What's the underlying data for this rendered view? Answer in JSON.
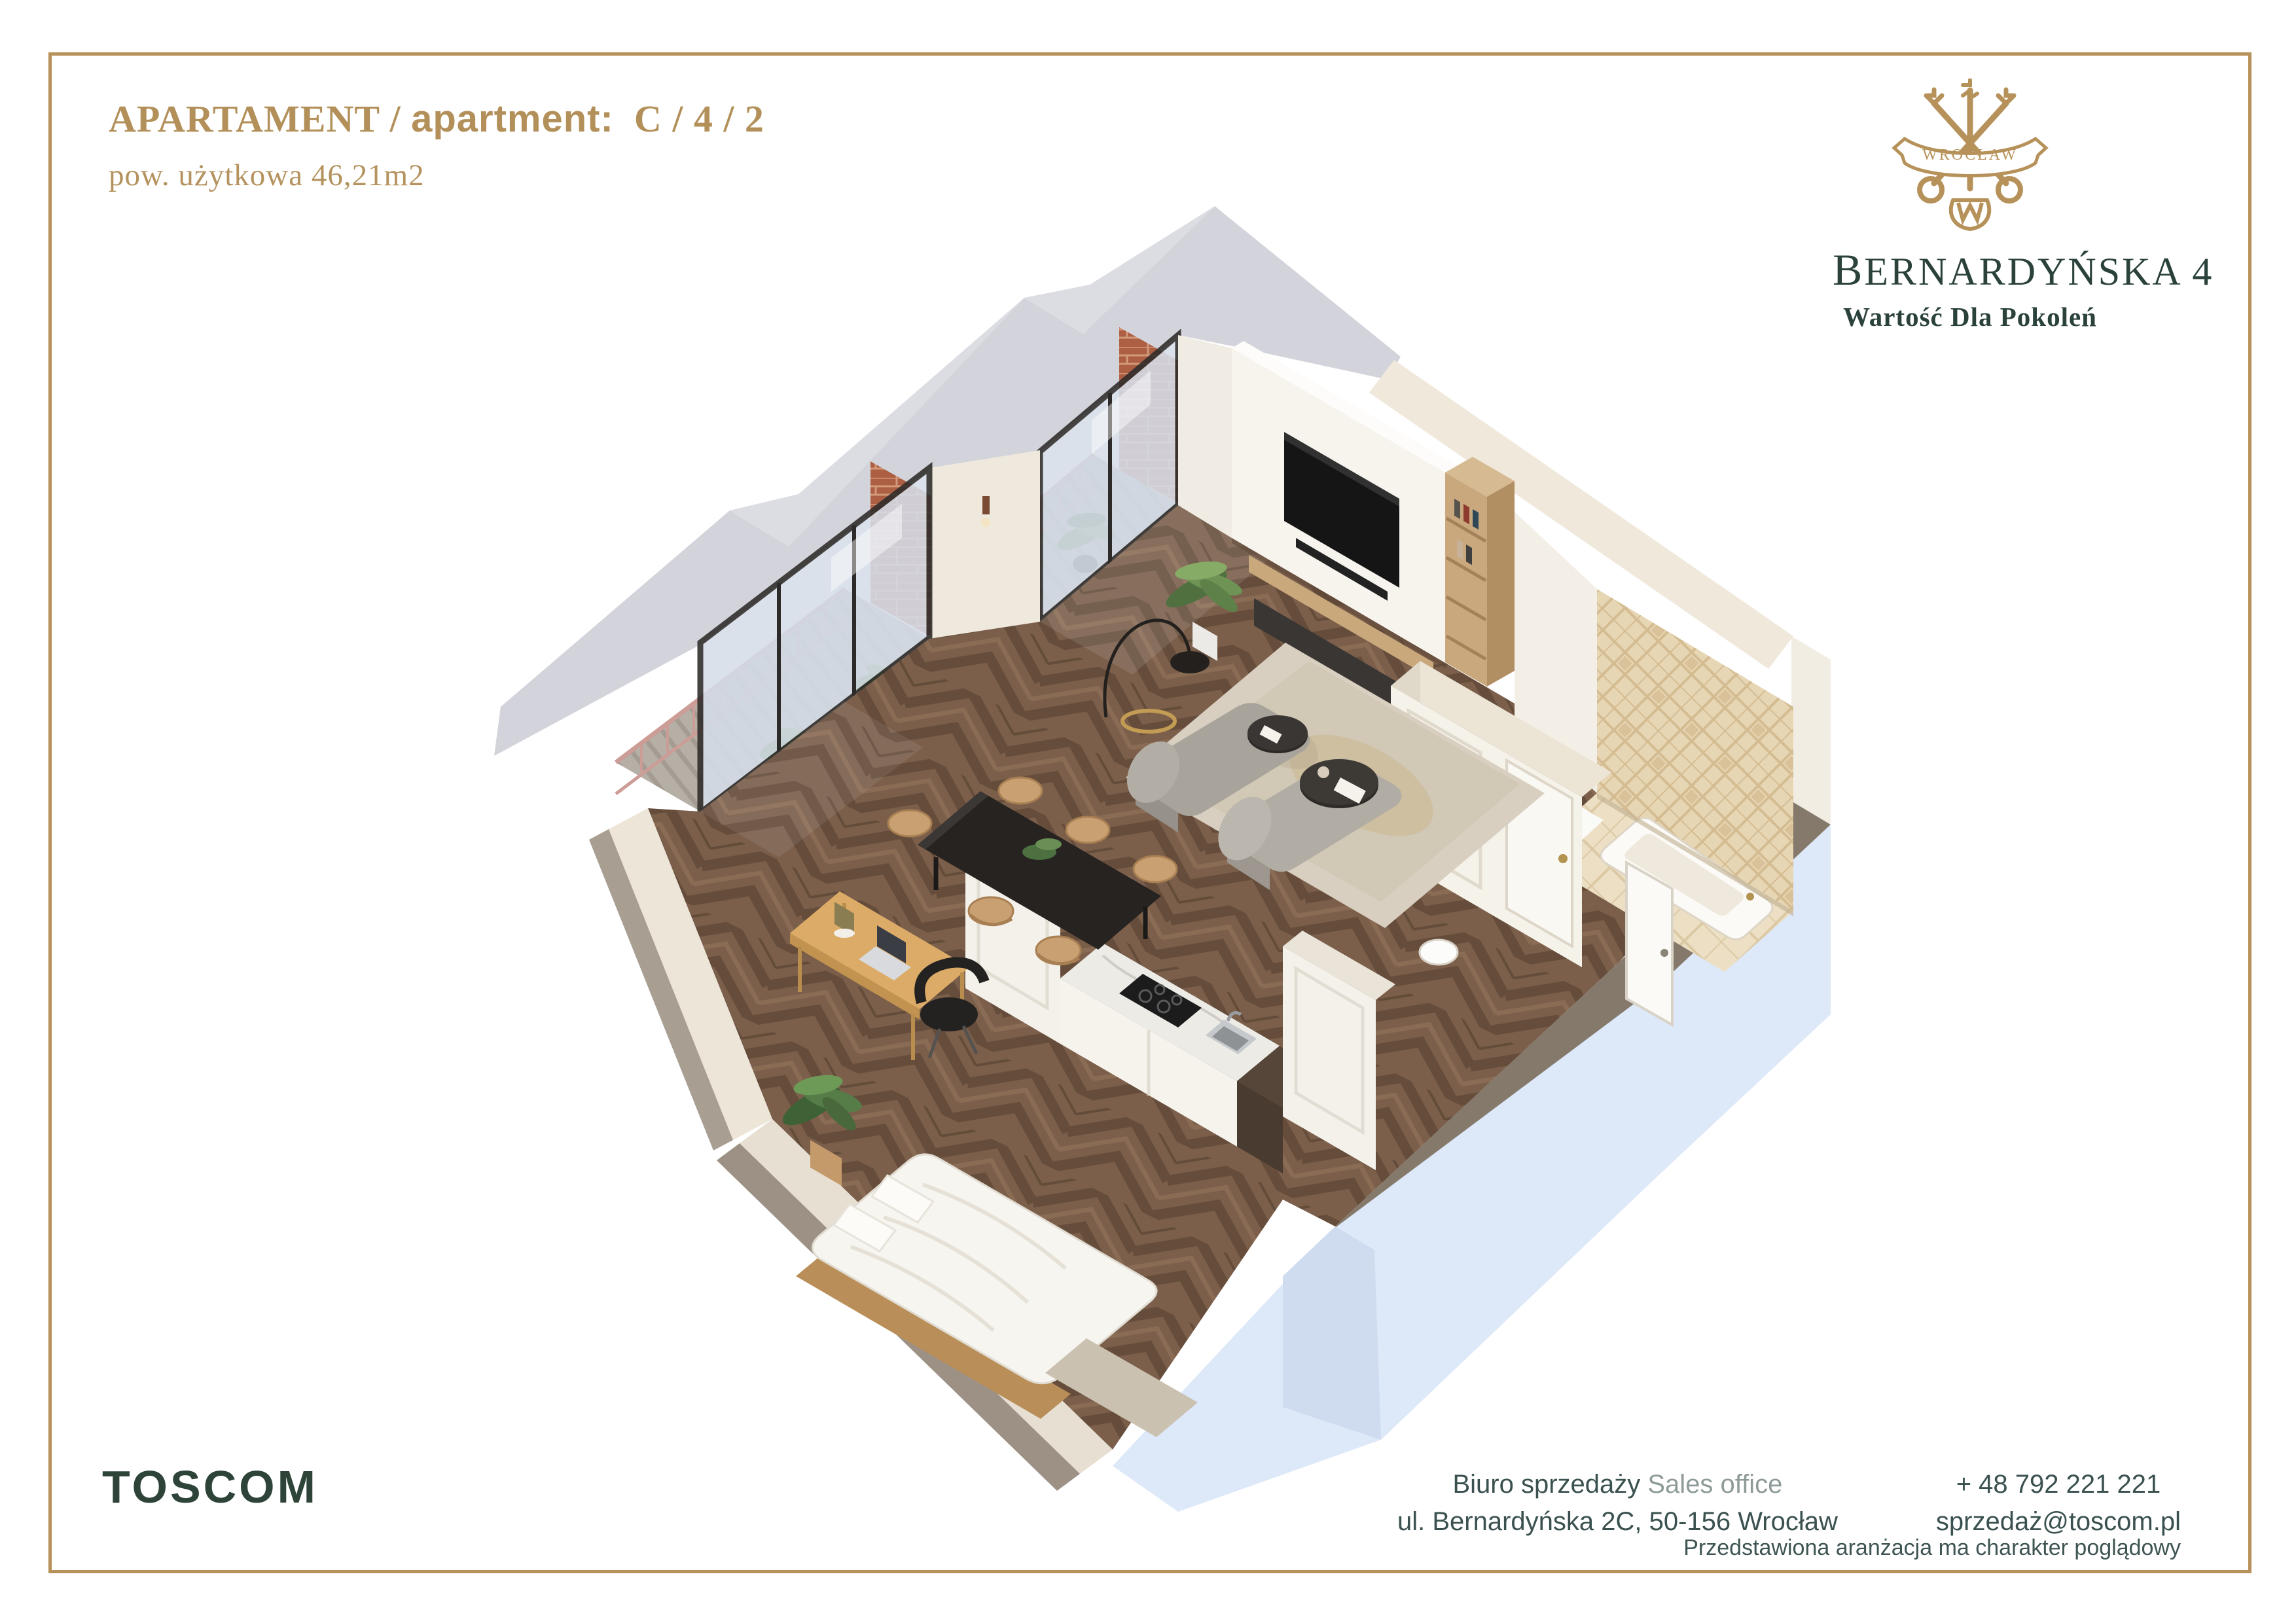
{
  "header": {
    "label_pl": "APARTAMENT",
    "separator": " / ",
    "label_en": "apartment:",
    "unit_code": "C / 4 / 2",
    "area_line": "pow. użytkowa 46,21m2"
  },
  "brand": {
    "logo_banner": "WROCŁAW",
    "project_first_letter": "B",
    "project_rest": "ERNARDYŃSKA 4",
    "tagline": "Wartość Dla Pokoleń"
  },
  "footer": {
    "company": "TOSCOM",
    "office_label_pl": "Biuro sprzedaży",
    "office_label_en": "Sales office",
    "address": "ul. Bernardyńska 2C, 50-156 Wrocław",
    "phone": "+ 48 792 221 221",
    "email": "sprzedaż@toscom.pl",
    "disclaimer": "Przedstawiona aranżacja ma charakter poglądowy"
  },
  "colors": {
    "gold": "#b6925a",
    "dark_green": "#2e4439",
    "contact_text": "#3a5150",
    "wood_floor": "#7b5f4b",
    "wall_cream": "#efe8db",
    "wall_cut_gray": "#d3d3db",
    "slab_blue": "#dde8f8",
    "slab_taupe": "#84796b",
    "bath_tile": "#e7d6b4",
    "railing_pink": "#cc9d96",
    "brick": "#b06848"
  },
  "floorplan": {
    "view": "3d-axonometric-cutaway",
    "rooms": [
      "living room",
      "dining area",
      "kitchen",
      "bedroom",
      "bathroom",
      "balcony",
      "balcony",
      "entry"
    ]
  }
}
